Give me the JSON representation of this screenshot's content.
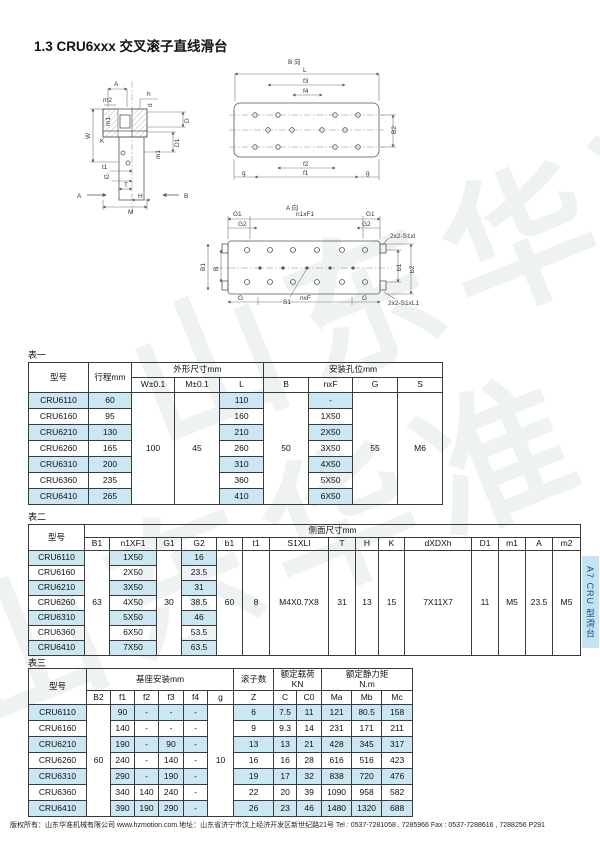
{
  "page": {
    "title": "1.3 CRU6xxx 交叉滚子直线滑台",
    "side_tab": "A7 CRU 型滑台",
    "watermark": "山东华准",
    "footer": "版权所有：山东华准机械有限公司 www.hzmotion.com 地址：山东省济宁市汶上经济开发区新世纪路21号 Tel : 0537-7281058 , 7285966 Fax : 0537-7288616 , 7288256  P291",
    "colors": {
      "highlight": "#cbe7f2",
      "tab_bg": "#c2e3ef",
      "tab_text": "#1d4e8a",
      "border": "#3a3a3a"
    }
  },
  "drawing": {
    "section": {
      "labels": {
        "A_top": "A",
        "m2": "m2",
        "h": "h",
        "d": "d",
        "D": "D",
        "D1": "D1",
        "m1_right": "m1",
        "W": "W",
        "m1_left": "m1",
        "K": "K",
        "t1": "t1",
        "t2": "t2",
        "T": "T",
        "H": "H",
        "M": "M",
        "arrow_A": "A",
        "arrow_B": "B"
      }
    },
    "b_view": {
      "title": "B 向",
      "labels": {
        "L": "L",
        "f3": "f3",
        "f4": "f4",
        "B2": "B2",
        "f2": "f2",
        "f1": "f1",
        "g_left": "g",
        "g_right": "g"
      }
    },
    "a_view": {
      "title": "A 向",
      "labels": {
        "G1_left": "G1",
        "n1xF1": "n1xF1",
        "G1_right": "G1",
        "G2_left": "G2",
        "G2_right": "G2",
        "top_right": "2x2-S1xl",
        "B1": "B1",
        "B": "B",
        "b1": "b1",
        "b2": "b2",
        "bottom_right": "2x2-S1xL1",
        "G_left": "G",
        "nxF": "nxF",
        "G_right": "G",
        "S1": "S1"
      }
    }
  },
  "table1": {
    "label": "表一",
    "headers": {
      "model": "型号",
      "stroke": "行程mm",
      "dims_group": "外形尺寸mm",
      "mount_group": "安装孔位mm",
      "w": "W±0.1",
      "m": "M±0.1",
      "l": "L",
      "b": "B",
      "nxf": "nxF",
      "g": "G",
      "s": "S"
    },
    "merged": {
      "w": "100",
      "m": "45",
      "b": "50",
      "g": "55",
      "s": "M6"
    },
    "rows": [
      {
        "model": "CRU6110",
        "stroke": "60",
        "l": "110",
        "nxf": "-"
      },
      {
        "model": "CRU6160",
        "stroke": "95",
        "l": "160",
        "nxf": "1X50"
      },
      {
        "model": "CRU6210",
        "stroke": "130",
        "l": "210",
        "nxf": "2X50"
      },
      {
        "model": "CRU6260",
        "stroke": "165",
        "l": "260",
        "nxf": "3X50"
      },
      {
        "model": "CRU6310",
        "stroke": "200",
        "l": "310",
        "nxf": "4X50"
      },
      {
        "model": "CRU6360",
        "stroke": "235",
        "l": "360",
        "nxf": "5X50"
      },
      {
        "model": "CRU6410",
        "stroke": "265",
        "l": "410",
        "nxf": "6X50"
      }
    ]
  },
  "table2": {
    "label": "表二",
    "headers": {
      "model": "型号",
      "group": "侧面尺寸mm",
      "cols": [
        "B1",
        "n1XF1",
        "G1",
        "G2",
        "b1",
        "t1",
        "S1XLI",
        "T",
        "H",
        "K",
        "dXDXh",
        "D1",
        "m1",
        "A",
        "m2"
      ]
    },
    "merged": {
      "B1": "63",
      "G1": "30",
      "b1": "60",
      "t1": "8",
      "s1xli": "M4X0.7X8",
      "T": "31",
      "H": "13",
      "K": "15",
      "dxdxh": "7X11X7",
      "D1": "11",
      "m1": "M5",
      "A": "23.5",
      "m2": "M5"
    },
    "rows": [
      {
        "model": "CRU6110",
        "n1xf1": "1X50",
        "g2": "16"
      },
      {
        "model": "CRU6160",
        "n1xf1": "2X50",
        "g2": "23.5"
      },
      {
        "model": "CRU6210",
        "n1xf1": "3X50",
        "g2": "31"
      },
      {
        "model": "CRU6260",
        "n1xf1": "4X50",
        "g2": "38.5"
      },
      {
        "model": "CRU6310",
        "n1xf1": "5X50",
        "g2": "46"
      },
      {
        "model": "CRU6360",
        "n1xf1": "6X50",
        "g2": "53.5"
      },
      {
        "model": "CRU6410",
        "n1xf1": "7X50",
        "g2": "63.5"
      }
    ]
  },
  "table3": {
    "label": "表三",
    "headers": {
      "model": "型号",
      "base_group": "基座安装mm",
      "roller_group": "滚子数",
      "load_group": "额定载荷",
      "load_unit": "KN",
      "moment_group": "额定静力矩",
      "moment_unit": "N.m",
      "cols": [
        "B2",
        "f1",
        "f2",
        "f3",
        "f4",
        "g",
        "Z",
        "C",
        "C0",
        "Ma",
        "Mb",
        "Mc"
      ]
    },
    "merged": {
      "b2": "60",
      "g": "10"
    },
    "rows": [
      {
        "model": "CRU6110",
        "f1": "90",
        "f2": "-",
        "f3": "-",
        "f4": "-",
        "z": "6",
        "c": "7.5",
        "c0": "11",
        "ma": "121",
        "mb": "80.5",
        "mc": "158"
      },
      {
        "model": "CRU6160",
        "f1": "140",
        "f2": "-",
        "f3": "-",
        "f4": "-",
        "z": "9",
        "c": "9.3",
        "c0": "14",
        "ma": "231",
        "mb": "171",
        "mc": "211"
      },
      {
        "model": "CRU6210",
        "f1": "190",
        "f2": "-",
        "f3": "90",
        "f4": "-",
        "z": "13",
        "c": "13",
        "c0": "21",
        "ma": "428",
        "mb": "345",
        "mc": "317"
      },
      {
        "model": "CRU6260",
        "f1": "240",
        "f2": "-",
        "f3": "140",
        "f4": "-",
        "z": "16",
        "c": "16",
        "c0": "28",
        "ma": "616",
        "mb": "516",
        "mc": "423"
      },
      {
        "model": "CRU6310",
        "f1": "290",
        "f2": "-",
        "f3": "190",
        "f4": "-",
        "z": "19",
        "c": "17",
        "c0": "32",
        "ma": "838",
        "mb": "720",
        "mc": "476"
      },
      {
        "model": "CRU6360",
        "f1": "340",
        "f2": "140",
        "f3": "240",
        "f4": "-",
        "z": "22",
        "c": "20",
        "c0": "39",
        "ma": "1090",
        "mb": "958",
        "mc": "582"
      },
      {
        "model": "CRU6410",
        "f1": "390",
        "f2": "190",
        "f3": "290",
        "f4": "-",
        "z": "26",
        "c": "23",
        "c0": "46",
        "ma": "1480",
        "mb": "1320",
        "mc": "688"
      }
    ]
  }
}
